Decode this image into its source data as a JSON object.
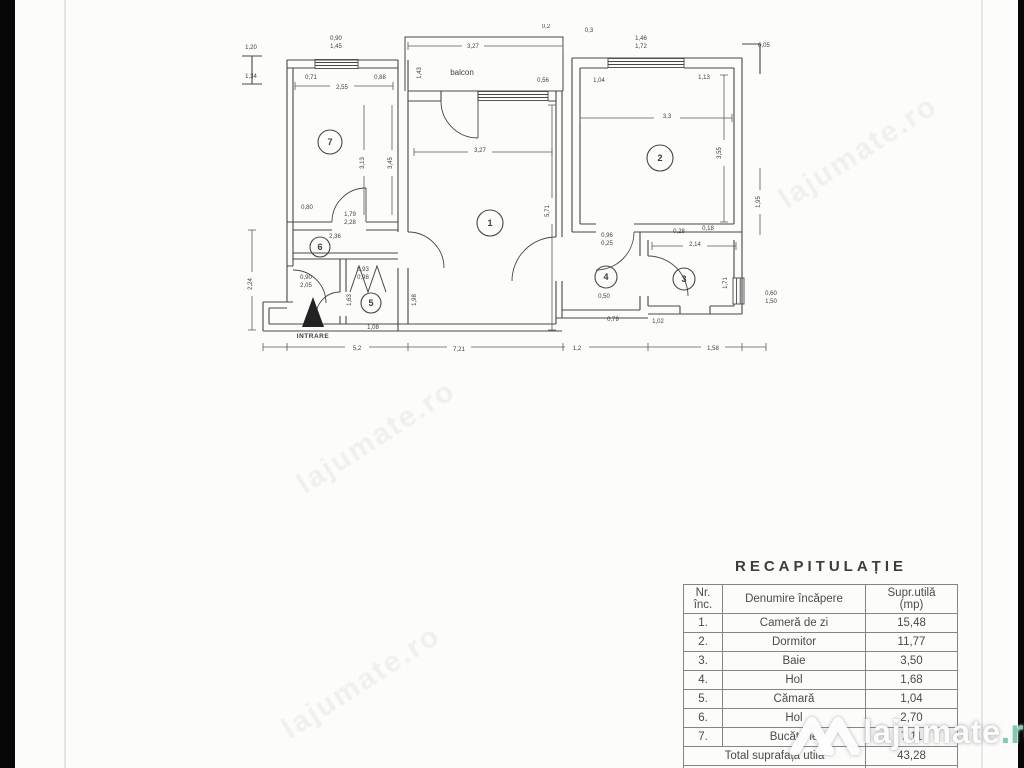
{
  "plan": {
    "balcony_label": "balcon",
    "entrance_label": "INTRARE",
    "rooms": [
      {
        "n": "1",
        "x": 490,
        "y": 223,
        "r": 13
      },
      {
        "n": "2",
        "x": 660,
        "y": 158,
        "r": 13
      },
      {
        "n": "3",
        "x": 684,
        "y": 279,
        "r": 11
      },
      {
        "n": "4",
        "x": 606,
        "y": 277,
        "r": 11
      },
      {
        "n": "5",
        "x": 371,
        "y": 303,
        "r": 10
      },
      {
        "n": "6",
        "x": 320,
        "y": 247,
        "r": 10
      },
      {
        "n": "7",
        "x": 330,
        "y": 142,
        "r": 12
      }
    ],
    "dims": [
      {
        "v": "3,27",
        "x": 473,
        "y": 48
      },
      {
        "v": "0,90",
        "x": 336,
        "y": 40
      },
      {
        "v": "1,45",
        "x": 336,
        "y": 48
      },
      {
        "v": "1,20",
        "x": 251,
        "y": 49
      },
      {
        "v": "1,34",
        "x": 251,
        "y": 78
      },
      {
        "v": "0,71",
        "x": 311,
        "y": 79
      },
      {
        "v": "0,88",
        "x": 380,
        "y": 79
      },
      {
        "v": "2,55",
        "x": 342,
        "y": 89
      },
      {
        "v": "1,43",
        "x": 421,
        "y": 73,
        "rot": 1
      },
      {
        "v": "0,56",
        "x": 543,
        "y": 82
      },
      {
        "v": "3,27",
        "x": 480,
        "y": 152
      },
      {
        "v": "5,71",
        "x": 549,
        "y": 211,
        "rot": 1
      },
      {
        "v": "3,13",
        "x": 364,
        "y": 163,
        "rot": 1
      },
      {
        "v": "3,45",
        "x": 392,
        "y": 163,
        "rot": 1
      },
      {
        "v": "0,80",
        "x": 307,
        "y": 209
      },
      {
        "v": "2,36",
        "x": 335,
        "y": 238
      },
      {
        "v": "1,79",
        "x": 350,
        "y": 216
      },
      {
        "v": "2,28",
        "x": 350,
        "y": 224
      },
      {
        "v": "0,2",
        "x": 546,
        "y": 28
      },
      {
        "v": "0,3",
        "x": 589,
        "y": 32
      },
      {
        "v": "1,46",
        "x": 641,
        "y": 40
      },
      {
        "v": "1,72",
        "x": 641,
        "y": 48
      },
      {
        "v": "0,05",
        "x": 764,
        "y": 47
      },
      {
        "v": "1,04",
        "x": 599,
        "y": 82
      },
      {
        "v": "1,13",
        "x": 704,
        "y": 79
      },
      {
        "v": "3,3",
        "x": 667,
        "y": 118
      },
      {
        "v": "3,55",
        "x": 721,
        "y": 153,
        "rot": 1
      },
      {
        "v": "1,95",
        "x": 760,
        "y": 202,
        "rot": 1
      },
      {
        "v": "0,28",
        "x": 679,
        "y": 233
      },
      {
        "v": "0,18",
        "x": 708,
        "y": 230
      },
      {
        "v": "2,14",
        "x": 695,
        "y": 246
      },
      {
        "v": "0,96",
        "x": 607,
        "y": 237
      },
      {
        "v": "0,25",
        "x": 607,
        "y": 245
      },
      {
        "v": "1,71",
        "x": 727,
        "y": 283,
        "rot": 1
      },
      {
        "v": "0,60",
        "x": 771,
        "y": 295
      },
      {
        "v": "1,50",
        "x": 771,
        "y": 303
      },
      {
        "v": "0,50",
        "x": 604,
        "y": 298
      },
      {
        "v": "0,79",
        "x": 613,
        "y": 321
      },
      {
        "v": "1,02",
        "x": 658,
        "y": 323
      },
      {
        "v": "0,93",
        "x": 363,
        "y": 271
      },
      {
        "v": "0,98",
        "x": 363,
        "y": 279
      },
      {
        "v": "1,63",
        "x": 351,
        "y": 300,
        "rot": 1
      },
      {
        "v": "1,08",
        "x": 373,
        "y": 329
      },
      {
        "v": "1,98",
        "x": 416,
        "y": 300,
        "rot": 1
      },
      {
        "v": "2,24",
        "x": 252,
        "y": 284,
        "rot": 1
      },
      {
        "v": "0,90",
        "x": 306,
        "y": 279
      },
      {
        "v": "2,05",
        "x": 306,
        "y": 287
      },
      {
        "v": "5,2",
        "x": 357,
        "y": 350
      },
      {
        "v": "7,21",
        "x": 459,
        "y": 351
      },
      {
        "v": "1,2",
        "x": 577,
        "y": 350
      },
      {
        "v": "1,58",
        "x": 713,
        "y": 350
      }
    ]
  },
  "table": {
    "title": "RECAPITULAȚIE",
    "headers": {
      "col1_line1": "Nr.",
      "col1_line2": "înc.",
      "col2": "Denumire încăpere",
      "col3_line1": "Supr.utilă",
      "col3_line2": "(mp)"
    },
    "rows": [
      {
        "nr": "1.",
        "name": "Cameră de zi",
        "area": "15,48"
      },
      {
        "nr": "2.",
        "name": "Dormitor",
        "area": "11,77"
      },
      {
        "nr": "3.",
        "name": "Baie",
        "area": "3,50"
      },
      {
        "nr": "4.",
        "name": "Hol",
        "area": "1,68"
      },
      {
        "nr": "5.",
        "name": "Cămară",
        "area": "1,04"
      },
      {
        "nr": "6.",
        "name": "Hol",
        "area": "2,70"
      },
      {
        "nr": "7.",
        "name": "Bucătărie",
        "area": "7,11"
      }
    ],
    "total": {
      "label": "Total suprafață utilă",
      "value": "43,28"
    },
    "balcony": {
      "label": "Supr. balcon",
      "value": "3,42"
    }
  },
  "watermark": {
    "brand_text": "lajumate",
    "brand_tld": ".ro",
    "tld_color": "#7fcab6",
    "diagonal_text": "lajumate.ro",
    "diagonals": [
      {
        "x": 782,
        "y": 185
      },
      {
        "x": 300,
        "y": 470
      },
      {
        "x": 285,
        "y": 715
      }
    ]
  }
}
